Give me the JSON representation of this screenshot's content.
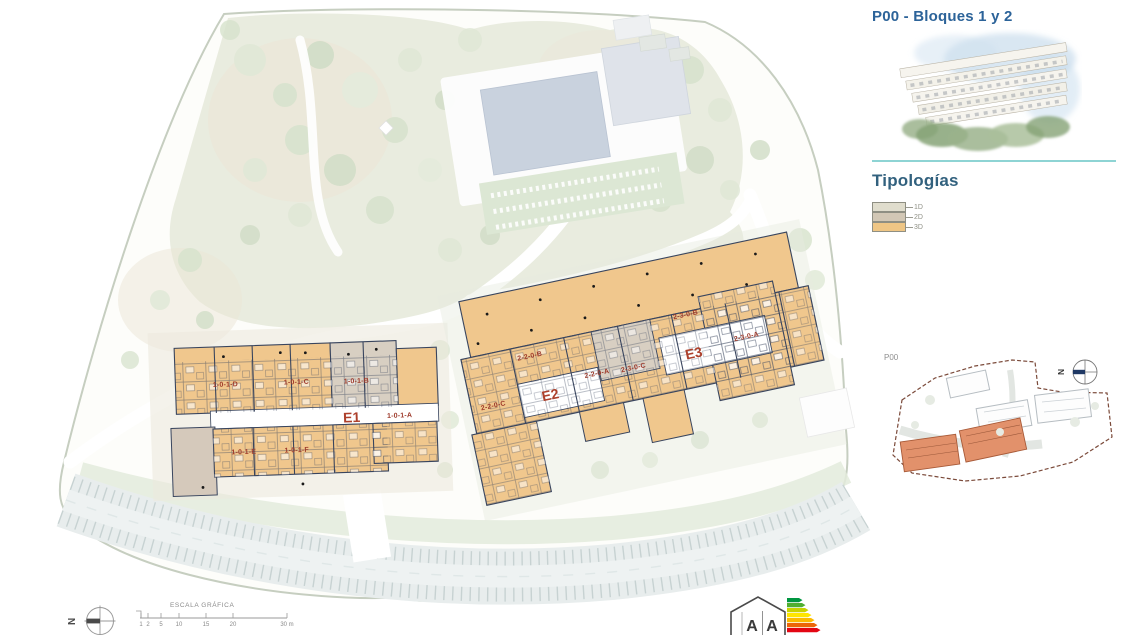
{
  "panel": {
    "title": "P00 - Bloques 1 y 2",
    "typologies_heading": "Tipologías",
    "typologies": [
      {
        "label": "1D",
        "color": "#e0ddcd"
      },
      {
        "label": "2D",
        "color": "#d2c7b5"
      },
      {
        "label": "3D",
        "color": "#efc685"
      }
    ]
  },
  "site_plan": {
    "block_labels": [
      {
        "text": "E1"
      },
      {
        "text": "E2"
      },
      {
        "text": "E3"
      }
    ],
    "unit_labels": [
      {
        "text": "1-0-1-D"
      },
      {
        "text": "1-0-1-C"
      },
      {
        "text": "1-0-1-B"
      },
      {
        "text": "1-0-1-A"
      },
      {
        "text": "1-0-1-E"
      },
      {
        "text": "1-0-1-F"
      },
      {
        "text": "2-2-0-B"
      },
      {
        "text": "2-2-0-A"
      },
      {
        "text": "2-2-0-C"
      },
      {
        "text": "2-3-0-B"
      },
      {
        "text": "2-3-0-C"
      },
      {
        "text": "2-3-0-A"
      }
    ]
  },
  "key_plan": {
    "label": "P00"
  },
  "compass": {
    "letter": "N"
  },
  "scale_bar": {
    "title": "ESCALA GRÁFICA",
    "ticks": [
      "1",
      "2",
      "5",
      "10",
      "15",
      "20"
    ],
    "end_label": "30 m"
  },
  "energy_logo": {
    "letters": [
      "A",
      "A"
    ]
  },
  "colors": {
    "title_blue": "#2c6399",
    "heading_blue": "#32617e",
    "accent_teal": "#8ed4d4",
    "building_3d_fill": "#f0c78d",
    "building_2d_fill": "#d8cfc2",
    "building_1d_fill": "#e0ddcd",
    "linework_navy": "#39455e",
    "unit_label_red": "#9e3a2b",
    "block_label_red": "#ad402c",
    "keyplan_highlight_orange": "#e2916b",
    "keyplan_boundary_brown": "#7b4a3a",
    "park_green": "#e9ecdf",
    "pool_blue": "#c9d2de"
  }
}
